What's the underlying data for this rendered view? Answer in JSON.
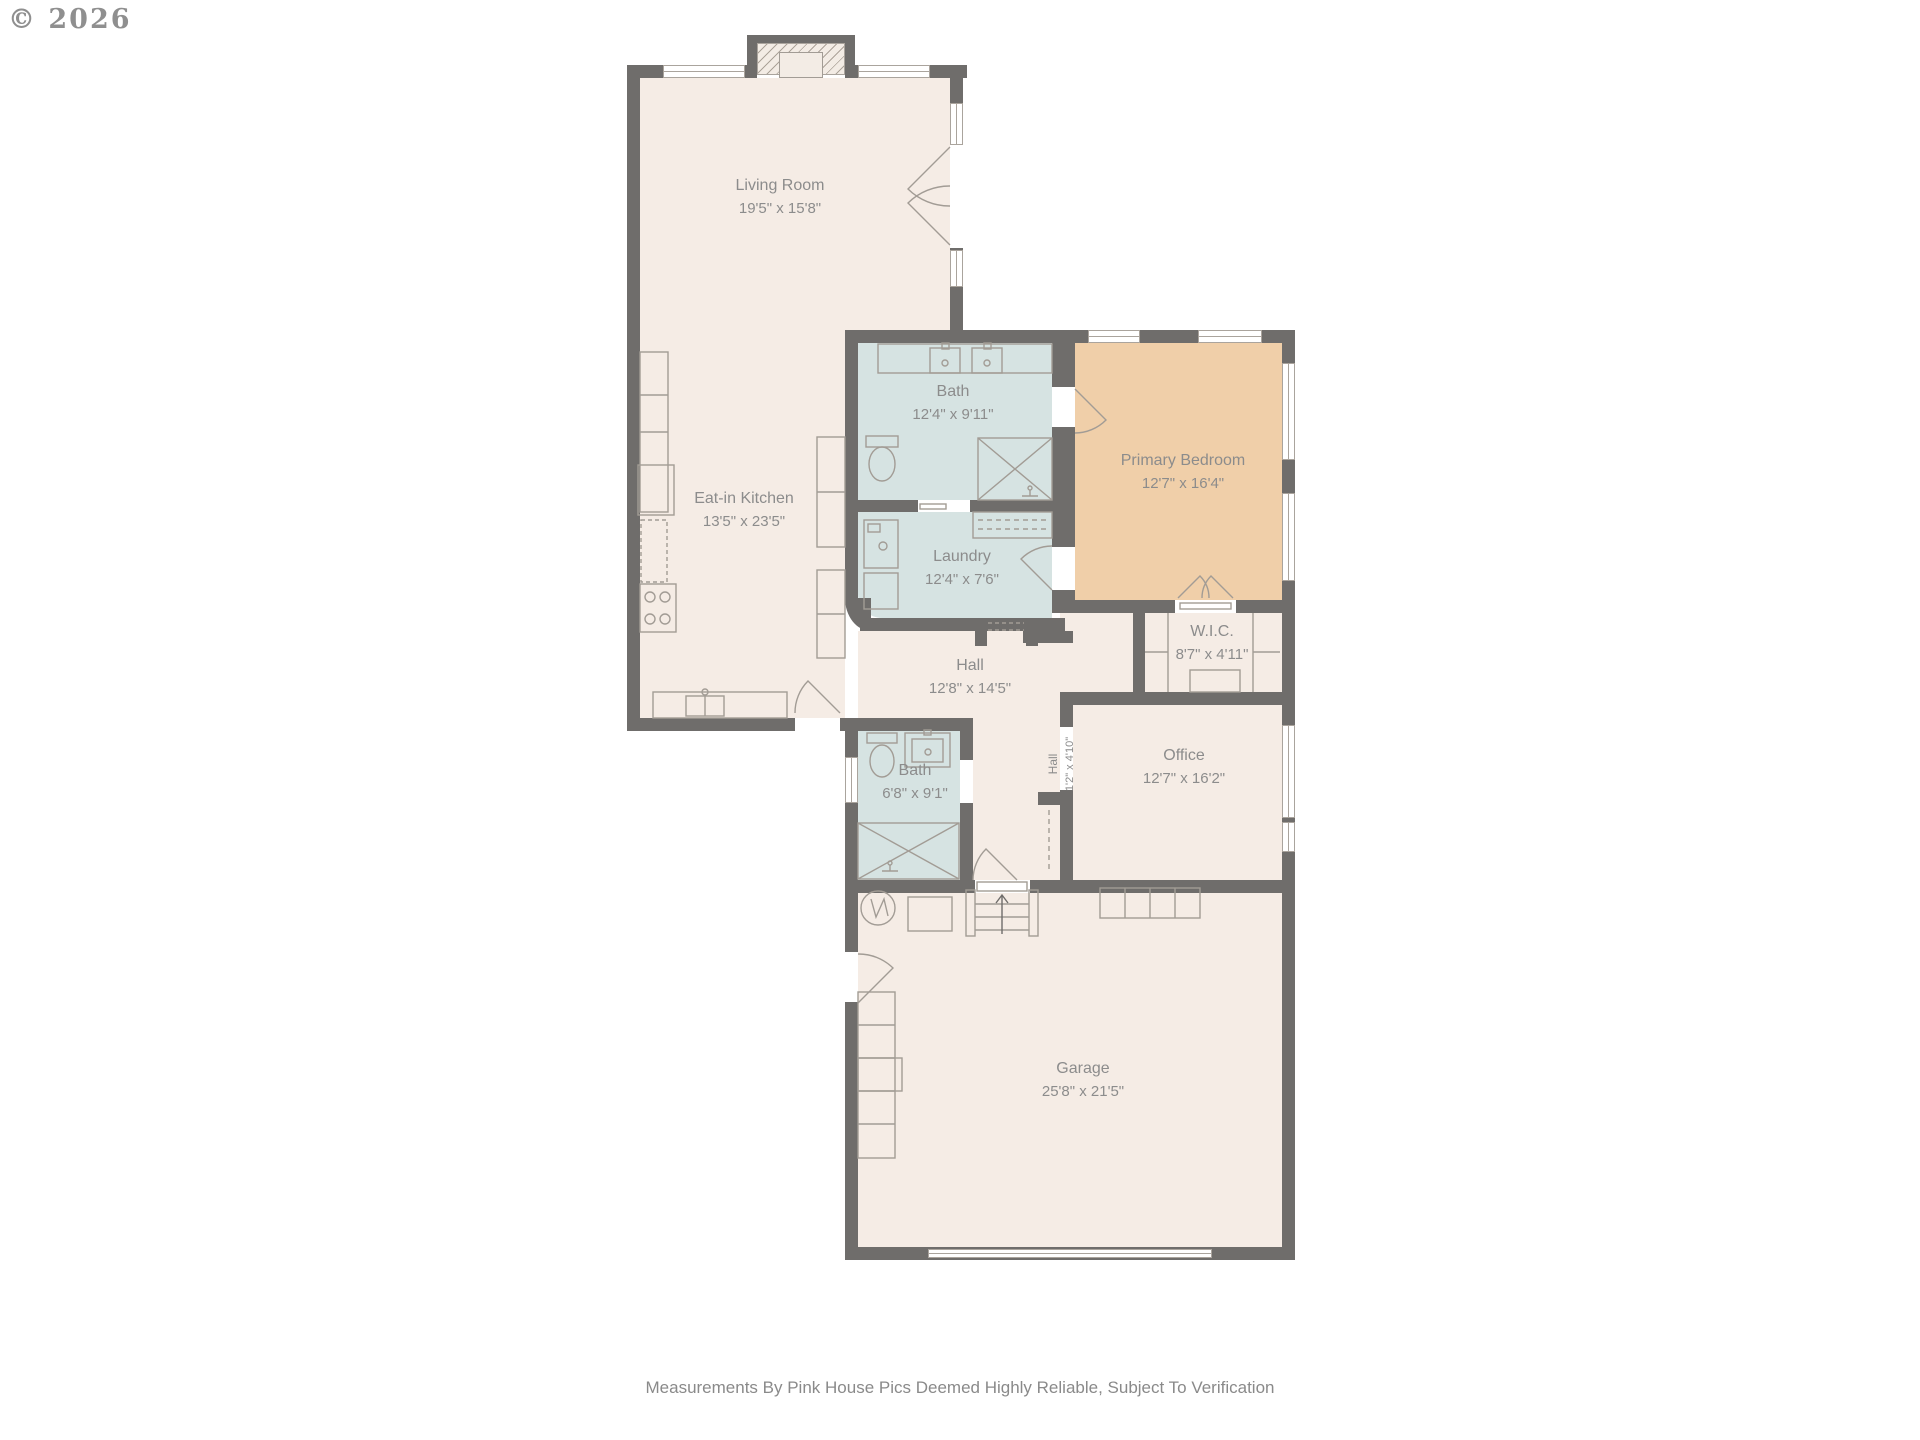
{
  "copyright": "© 2026",
  "disclaimer": "Measurements By Pink House Pics Deemed Highly Reliable, Subject To Verification",
  "colors": {
    "wall": "#6f6d6b",
    "room_fill": "#f5ece5",
    "wet_room_fill": "#d6e3e2",
    "primary_bedroom_fill": "#f0cfa9",
    "label_text": "#8c8c8c"
  },
  "rooms": [
    {
      "name": "Living Room",
      "dims": "19'5\" x 15'8\""
    },
    {
      "name": "Eat-in Kitchen",
      "dims": "13'5\" x 23'5\""
    },
    {
      "name": "Bath",
      "dims": "12'4\" x 9'11\""
    },
    {
      "name": "Primary Bedroom",
      "dims": "12'7\" x 16'4\""
    },
    {
      "name": "Laundry",
      "dims": "12'4\" x 7'6\""
    },
    {
      "name": "W.I.C.",
      "dims": "8'7\" x 4'11\""
    },
    {
      "name": "Hall",
      "dims": "12'8\" x 14'5\""
    },
    {
      "name": "Hall",
      "dims": "1'2\" x 4'10\""
    },
    {
      "name": "Office",
      "dims": "12'7\" x 16'2\""
    },
    {
      "name": "Bath",
      "dims": "6'8\" x 9'1\""
    },
    {
      "name": "Garage",
      "dims": "25'8\" x 21'5\""
    }
  ]
}
